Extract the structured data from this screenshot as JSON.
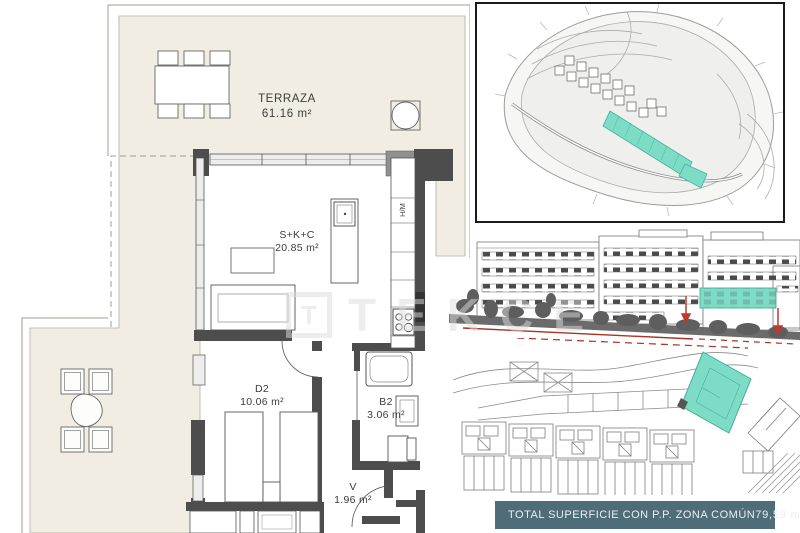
{
  "floor_plan": {
    "rooms": [
      {
        "name": "TERRAZA",
        "area": "61.16 m²"
      },
      {
        "name": "S+K+C",
        "area": "20.85 m²"
      },
      {
        "name": "D2",
        "area": "10.06 m²"
      },
      {
        "name": "B2",
        "area": "3.06 m²"
      },
      {
        "name": "V",
        "area": "1.96 m²"
      }
    ],
    "appliance_label": "H/M"
  },
  "watermark": {
    "logo_letter": "T",
    "brand": "TEKCE"
  },
  "summary_bar": {
    "label": "TOTAL SUPERFICIE CON P.P. ZONA COMÚN",
    "value": "79,59 m²"
  },
  "colors": {
    "unit_highlight": "#7ddcc6",
    "summary_bar_bg": "#4e6d79",
    "terrace_fill": "#f1ede3",
    "wall": "#4d4d4d",
    "section_line_red": "#a93226"
  }
}
